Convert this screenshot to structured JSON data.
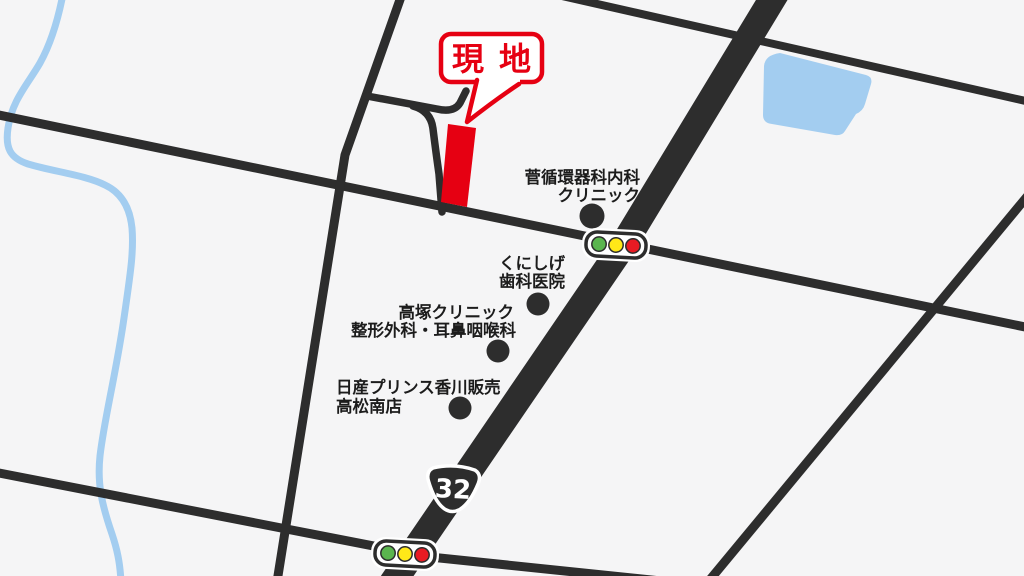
{
  "map": {
    "site_callout": {
      "label": "現地"
    },
    "route_shield": {
      "number": "32"
    },
    "landmarks": [
      {
        "id": "kan-junkanki",
        "line1": "菅循環器科内科",
        "line2": "クリニック"
      },
      {
        "id": "kunishige",
        "line1": "くにしげ",
        "line2": "歯科医院"
      },
      {
        "id": "takatsuka",
        "line1": "高塚クリニック",
        "line2": "整形外科・耳鼻咽喉科"
      },
      {
        "id": "nissan-prince",
        "line1": "日産プリンス香川販売",
        "line2": "高松南店"
      }
    ],
    "icons": {
      "traffic_signal": "rounded box with green / yellow / red lamps",
      "route_shield": "national-route onigiri badge",
      "site_marker": "red parcel rectangle",
      "landmark_dot": "black circle"
    },
    "colors": {
      "background": "#f5f5f6",
      "road": "#2d2d2d",
      "water": "#a3cdf0",
      "accent_red": "#e60012",
      "signal_green": "#5ab54e",
      "signal_yellow": "#ffe818",
      "signal_red": "#e81b23"
    }
  }
}
